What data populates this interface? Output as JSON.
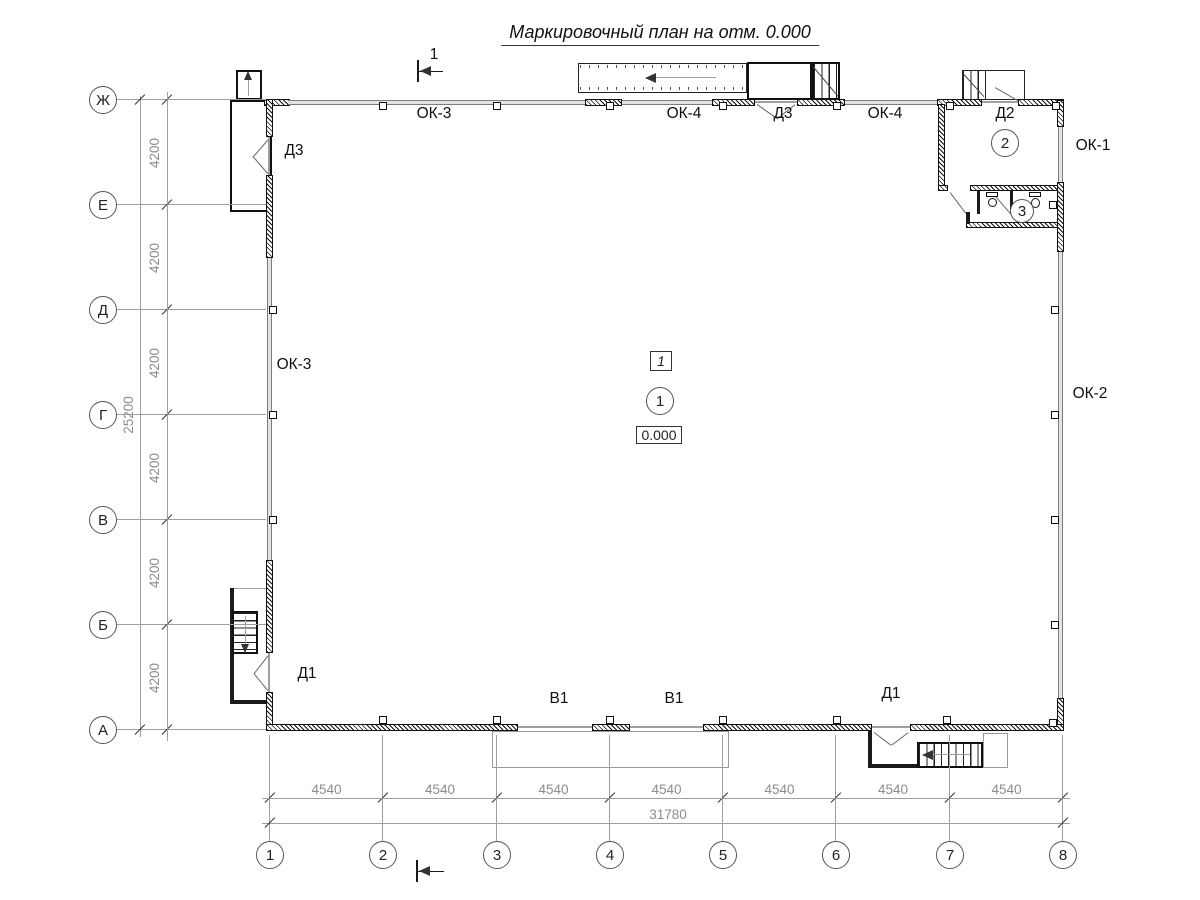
{
  "title": "Маркировочный план на отм. 0.000",
  "section_mark": {
    "label": "1"
  },
  "axes": {
    "rows": [
      {
        "label": "Ж"
      },
      {
        "label": "Е"
      },
      {
        "label": "Д"
      },
      {
        "label": "Г"
      },
      {
        "label": "В"
      },
      {
        "label": "Б"
      },
      {
        "label": "А"
      }
    ],
    "cols": [
      {
        "label": "1"
      },
      {
        "label": "2"
      },
      {
        "label": "3"
      },
      {
        "label": "4"
      },
      {
        "label": "5"
      },
      {
        "label": "6"
      },
      {
        "label": "7"
      },
      {
        "label": "8"
      }
    ]
  },
  "dimensions": {
    "row_spacing": [
      "4200",
      "4200",
      "4200",
      "4200",
      "4200",
      "4200"
    ],
    "row_total": "25200",
    "col_spacing": [
      "4540",
      "4540",
      "4540",
      "4540",
      "4540",
      "4540",
      "4540"
    ],
    "col_total": "31780"
  },
  "openings": {
    "ok3_top": "ОК-3",
    "ok4_top_left": "ОК-4",
    "d3_top": "Д3",
    "ok4_top_right": "ОК-4",
    "d2_top": "Д2",
    "d3_left": "Д3",
    "ok3_left": "ОК-3",
    "d1_left": "Д1",
    "ok1_right": "ОК-1",
    "ok2_right": "ОК-2",
    "v1_left": "В1",
    "v1_right": "В1",
    "d1_right": "Д1"
  },
  "markers": {
    "room_type": "1",
    "rooms": [
      {
        "number": "1"
      },
      {
        "number": "2"
      },
      {
        "number": "3"
      }
    ],
    "elevation": "0.000"
  },
  "colors": {
    "line": "#1a1a1a",
    "dim_text": "#8c8c8c",
    "window_band": "#e3e3e3"
  }
}
